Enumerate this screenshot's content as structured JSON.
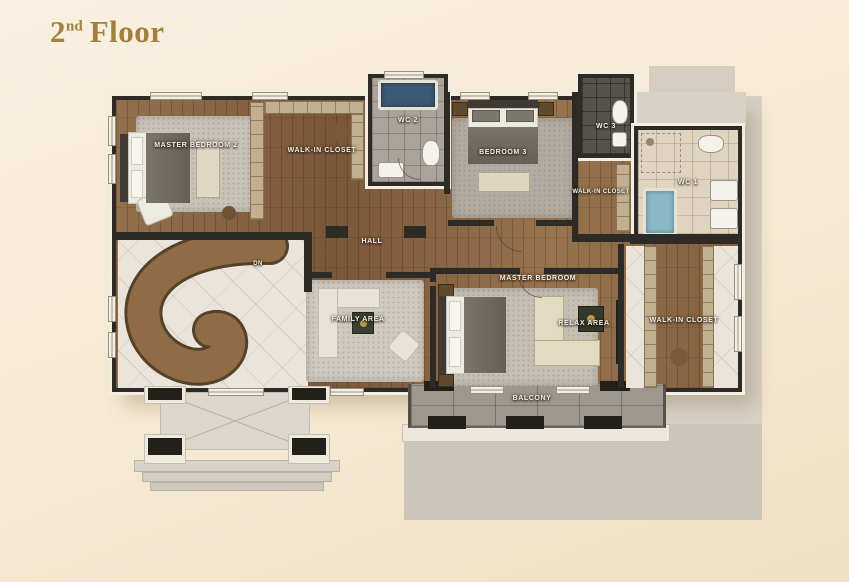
{
  "title": {
    "number": "2",
    "ordinal": "nd",
    "word": "Floor"
  },
  "plan": {
    "rooms": {
      "master_bedroom_2": "MASTER BEDROOM 2",
      "walk_in_closet_top": "WALK-IN CLOSET",
      "wc_2": "WC 2",
      "bedroom_3": "BEDROOM 3",
      "wc_3": "WC 3",
      "walk_in_closet_mid": "WALK-IN CLOSET",
      "wc_1": "WC 1",
      "hall": "HALL",
      "stairs_direction": "DN",
      "family_area": "FAMILY AREA",
      "master_bedroom": "MASTER BEDROOM",
      "relax_area": "RELAX AREA",
      "walk_in_closet_master": "WALK-IN CLOSET",
      "balcony": "BALCONY"
    }
  },
  "colors": {
    "background": "#f6ead6",
    "title_gold": "#a2803f",
    "wall": "#2e2b26",
    "wood_floor": "#8a6746",
    "marble": "#eae4da",
    "bathroom_tile_light": "#ded4bf",
    "bathroom_tile_gray": "#a9a39b",
    "bathroom_tile_dark": "#56524c",
    "balcony_stone": "#9d978d",
    "roof_gray": "#d8d2c5",
    "tub_water_blue": "#8ab8c6",
    "label_text": "#f2eee4"
  }
}
